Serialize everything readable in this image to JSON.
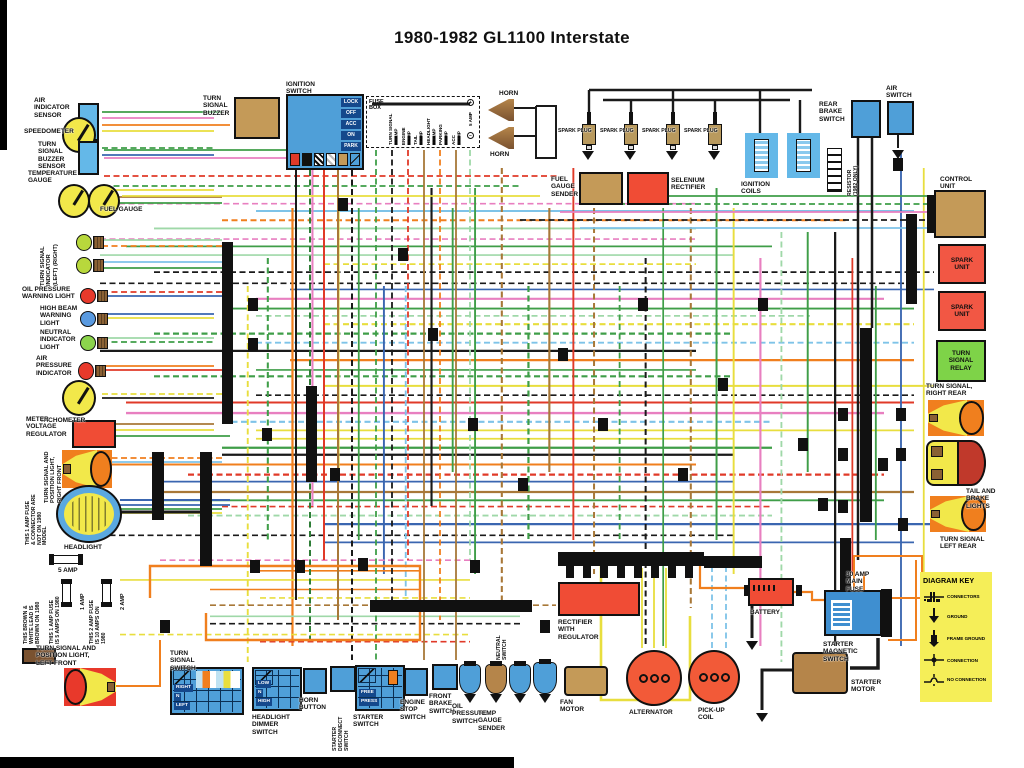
{
  "title": "1980-1982 GL1100 Interstate",
  "palette": {
    "k": "#1a1a1a",
    "r": "#e03a28",
    "o": "#f07f1e",
    "y": "#e8de3e",
    "g": "#3f9e48",
    "lg": "#9fd8a8",
    "b": "#3a66b0",
    "lb": "#7ec3e8",
    "p": "#e87fc0",
    "br": "#a87838",
    "dg": "#2e7d36",
    "comp_red": "#f04c35",
    "comp_tan": "#c49a58",
    "comp_blue": "#4f9fd8",
    "comp_lt_blue": "#64b8e8",
    "comp_green": "#7ed348",
    "comp_yellow": "#f2e84a"
  },
  "ignition_switch": {
    "title": "IGNITION\nSWITCH",
    "positions": [
      "LOCK",
      "OFF",
      "ACC",
      "ON",
      "PARK"
    ]
  },
  "fuse_box": {
    "title": "FUSE\nBOX",
    "slots": [
      {
        "name": "TURN SIGNAL",
        "amp": "15 AMP"
      },
      {
        "name": "ENGINE",
        "amp": "5 AMP"
      },
      {
        "name": "TAIL",
        "amp": "5 AMP"
      },
      {
        "name": "HEADLIGHT",
        "amp": "10 AMP"
      },
      {
        "name": "PARKING",
        "amp": "5 AMP"
      },
      {
        "name": "ACC",
        "amp": "5 AMP"
      }
    ],
    "terminal": {
      "amp": "5 AMP",
      "plus": "+",
      "minus": "−"
    }
  },
  "switches": {
    "turn_signal": {
      "label": "TURN\nSIGNAL\nSWITCH",
      "rows": [
        "RIGHT",
        "N",
        "LEFT"
      ]
    },
    "dimmer": {
      "label": "HEADLIGHT\nDIMMER\nSWITCH",
      "rows": [
        "LOW",
        "N",
        "HIGH"
      ]
    },
    "starter": {
      "label": "STARTER\nSWITCH",
      "rows": [
        "FREE",
        "PRESS"
      ]
    }
  },
  "diagram_key": {
    "title": "DIAGRAM KEY",
    "items": [
      "CONNECTORS",
      "GROUND",
      "FRAME GROUND",
      "CONNECTION",
      "NO CONNECTION"
    ]
  },
  "components": {
    "air_indicator_sensor": "AIR\nINDICATOR\nSENSOR",
    "speedometer": "SPEEDOMETER",
    "turn_signal_buzzer_sensor": "TURN\nSIGNAL\nBUZZER\nSENSOR",
    "temperature_gauge": "TEMPERATURE\nGAUGE",
    "fuel_gauge": "FUEL GAUGE",
    "turn_signal_indicator": "TURN SIGNAL\nINDICATOR\n(LEFT)   (RIGHT)",
    "oil_pressure_warning_light": "OIL PRESSURE\nWARNING LIGHT",
    "high_beam_warning_light": "HIGH BEAM\nWARNING\nLIGHT",
    "neutral_indicator_light": "NEUTRAL\nINDICATOR\nLIGHT",
    "air_pressure_indicator": "AIR\nPRESSURE\nINDICATOR",
    "tachometer": "TACHOMETER",
    "meter_voltage_regulator": "METER\nVOLTAGE\nREGULATOR",
    "ts_right_front": "TURN SIGNAL AND\nPOSITION LIGHT,\nRIGHT FRONT",
    "headlight": "HEADLIGHT",
    "fuse_5amp": "5 AMP",
    "fuse_1amp": "1 AMP",
    "fuse_2amp": "2 AMP",
    "note_1amp_connector": "THIS 1 AMP FUSE\n& CONNECTOR ARE\nNOT ON 1980\nMODEL",
    "note_brown_white": "THIS BROWN &\nWHITE LEAD IS\nBROWN ON 1980",
    "note_1amp_1980": "THIS 1 AMP FUSE\nIS 5 AMPS ON 1980",
    "note_2amp_1980": "THIS 2 AMP FUSE\nIS 10 AMPS ON\n1980",
    "ts_left_front": "TURN SIGNAL AND\nPOSITION LIGHT,\nLEFT FRONT",
    "turn_signal_buzzer": "TURN\nSIGNAL\nBUZZER",
    "horn": "HORN",
    "fuel_gauge_sender": "FUEL\nGAUGE\nSENDER",
    "selenium_rectifier": "SELENIUM\nRECTIFIER",
    "spark_plug": "SPARK PLUG",
    "ignition_coils": "IGNITION\nCOILS",
    "resistor": "RESISTOR\n(1982 ONLY)",
    "rear_brake_switch": "REAR\nBRAKE\nSWITCH",
    "air_switch": "AIR\nSWITCH",
    "control_unit": "CONTROL\nUNIT",
    "spark_unit": "SPARK\nUNIT",
    "turn_signal_relay": "TURN\nSIGNAL\nRELAY",
    "ts_right_rear": "TURN SIGNAL,\nRIGHT REAR",
    "tail_brake_lights": "TAIL AND\nBRAKE\nLIGHTS",
    "ts_left_rear": "TURN SIGNAL\nLEFT REAR",
    "rectifier_regulator": "RECTIFIER\nWITH\nREGULATOR",
    "fan_motor": "FAN\nMOTOR",
    "alternator": "ALTERNATOR",
    "pick_up_coil": "PICK-UP\nCOIL",
    "battery": "BATTERY",
    "main_fuse": "30 AMP\nMAIN\nFUSE",
    "starter_magnetic_switch": "STARTER\nMAGNETIC\nSWITCH",
    "starter_motor": "STARTER\nMOTOR",
    "horn_button": "HORN\nBUTTON",
    "starter_disconnect": "STARTER\nDISCONNECT\nSWITCH",
    "engine_stop_switch": "ENGINE\nSTOP\nSWITCH",
    "front_brake_switch": "FRONT\nBRAKE\nSWITCH",
    "oil_pressure_switch": "OIL\nPRESSURE\nSWITCH",
    "temp_gauge_sender": "TEMP\nGAUGE\nSENDER",
    "neutral_switch": "NEUTRAL\nSWITCH"
  }
}
